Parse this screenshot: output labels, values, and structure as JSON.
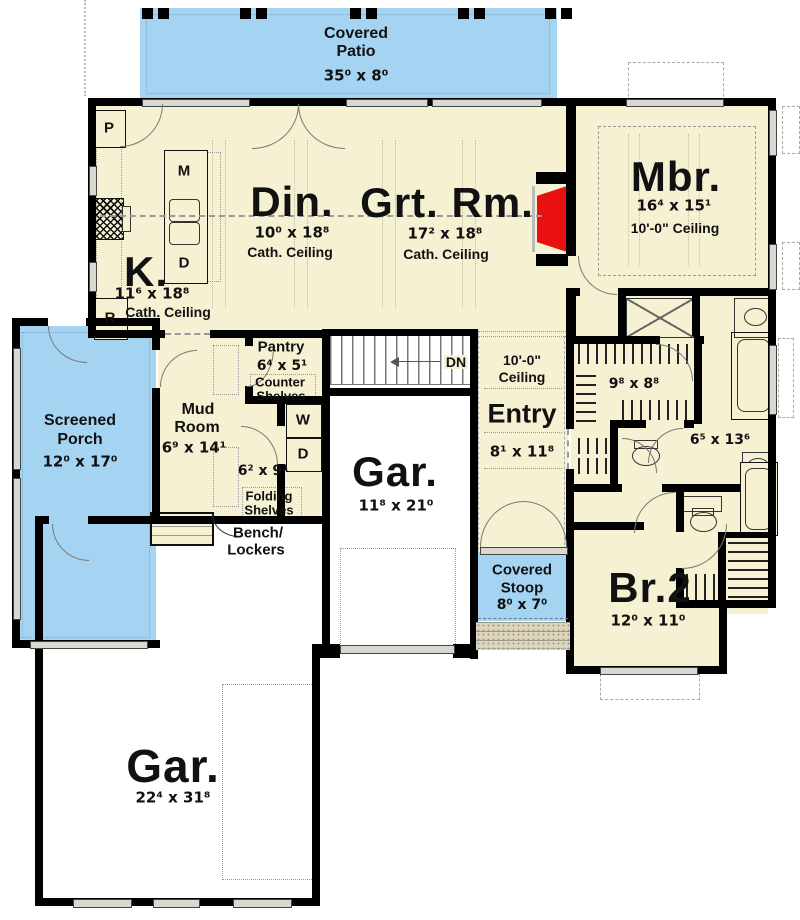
{
  "rooms": {
    "covered_patio": {
      "name1": "Covered",
      "name2": "Patio",
      "dims": "35⁰ x 8⁰"
    },
    "dining": {
      "label": "Din.",
      "dims": "10⁰ x 18⁸",
      "ceiling": "Cath. Ceiling"
    },
    "great_room": {
      "label": "Grt. Rm.",
      "dims": "17² x 18⁸",
      "ceiling": "Cath. Ceiling"
    },
    "kitchen": {
      "label": "K.",
      "dims": "11⁶ x 18⁸",
      "ceiling": "Cath. Ceiling"
    },
    "master_bedroom": {
      "label": "Mbr.",
      "dims": "16⁴ x 15¹",
      "ceiling": "10'-0\" Ceiling"
    },
    "screened_porch": {
      "name1": "Screened",
      "name2": "Porch",
      "dims": "12⁰ x 17⁰"
    },
    "pantry": {
      "label": "Pantry",
      "dims": "6⁴ x 5¹",
      "note1": "Counter",
      "note2": "Shelves"
    },
    "mud_room": {
      "name1": "Mud",
      "name2": "Room",
      "dims": "6⁹ x 14¹"
    },
    "laundry": {
      "dims": "6² x 9¹",
      "note1": "Folding",
      "note2": "Shelves"
    },
    "entry": {
      "ceiling1": "10'-0\"",
      "ceiling2": "Ceiling",
      "label": "Entry",
      "dims": "8¹ x 11⁸"
    },
    "garage_side": {
      "label": "Gar.",
      "dims": "11⁸ x 21⁰"
    },
    "covered_stoop": {
      "name1": "Covered",
      "name2": "Stoop",
      "dims": "8⁰ x 7⁰"
    },
    "bedroom2": {
      "label": "Br.2",
      "dims": "12⁰ x 11⁰"
    },
    "walk_in_closet": {
      "dims": "9⁸ x 8⁸"
    },
    "master_bath": {
      "dims": "6⁵ x 13⁶"
    },
    "garage_main": {
      "label": "Gar.",
      "dims": "22⁴ x 31⁸"
    }
  },
  "callouts": {
    "bench1": "Bench/",
    "bench2": "Lockers",
    "stairs_dn": "DN"
  },
  "appliances": {
    "pantry_cabinet": "P",
    "microwave": "M",
    "dishwasher": "D",
    "refrigerator": "R",
    "washer": "W",
    "dryer": "D"
  },
  "colors": {
    "room_fill": "#f7f1d3",
    "outdoor_fill": "#a5d4f2",
    "fireplace": "#e81010",
    "wall": "#000000"
  }
}
